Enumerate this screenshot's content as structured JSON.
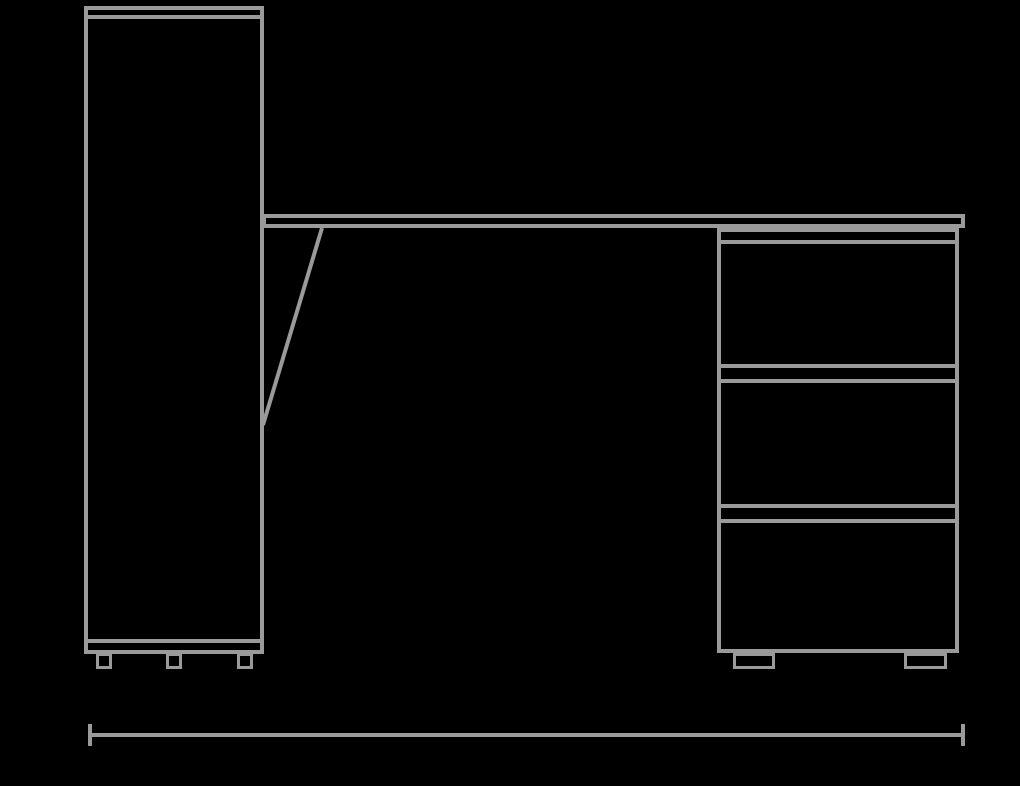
{
  "canvas": {
    "background_color": "#000000",
    "stroke_color": "#9a9a9a"
  },
  "drawing": {
    "type": "furniture-elevation-line-drawing",
    "components": {
      "cabinet": {
        "name": "tall-cabinet",
        "has_top_panel_line": true,
        "has_plinth_line": true,
        "feet_count": 3
      },
      "worktop": {
        "name": "desk-worktop",
        "attached_to": "cabinet-right-side",
        "support": "diagonal-brace"
      },
      "pedestal": {
        "name": "drawer-pedestal",
        "drawer_count": 3,
        "feet_count": 2
      },
      "dimension": {
        "name": "overall-width-dimension-line",
        "style": "end-ticks",
        "label_text": ""
      }
    }
  }
}
